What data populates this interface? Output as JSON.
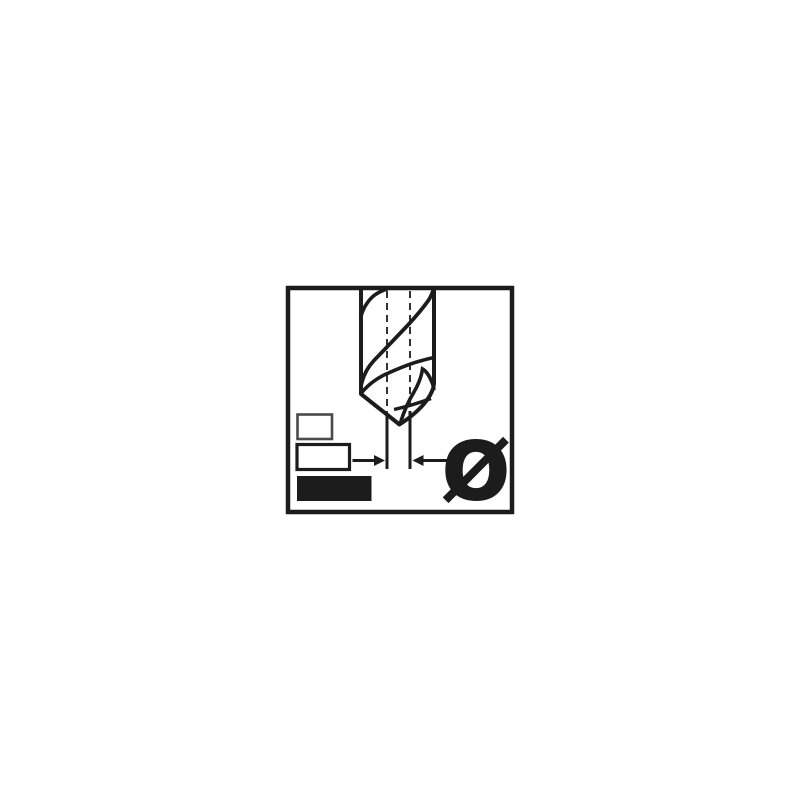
{
  "pictogram": {
    "name": "drill-bit-diameter-pictogram",
    "diameter_symbol": "Ø",
    "colors": {
      "ink": "#1c1c1c",
      "swatch_outline_small": "#4a4a4a",
      "background": "#ffffff"
    },
    "icons": {
      "drill": "drill-bit-icon",
      "diameter": "diameter-symbol",
      "arrows": "dimension-arrows",
      "centerlines": "dashed-centerlines"
    },
    "legend": {
      "swatches": [
        {
          "size": "small",
          "filled": false
        },
        {
          "size": "medium",
          "filled": false
        },
        {
          "size": "large",
          "filled": true
        }
      ]
    }
  }
}
